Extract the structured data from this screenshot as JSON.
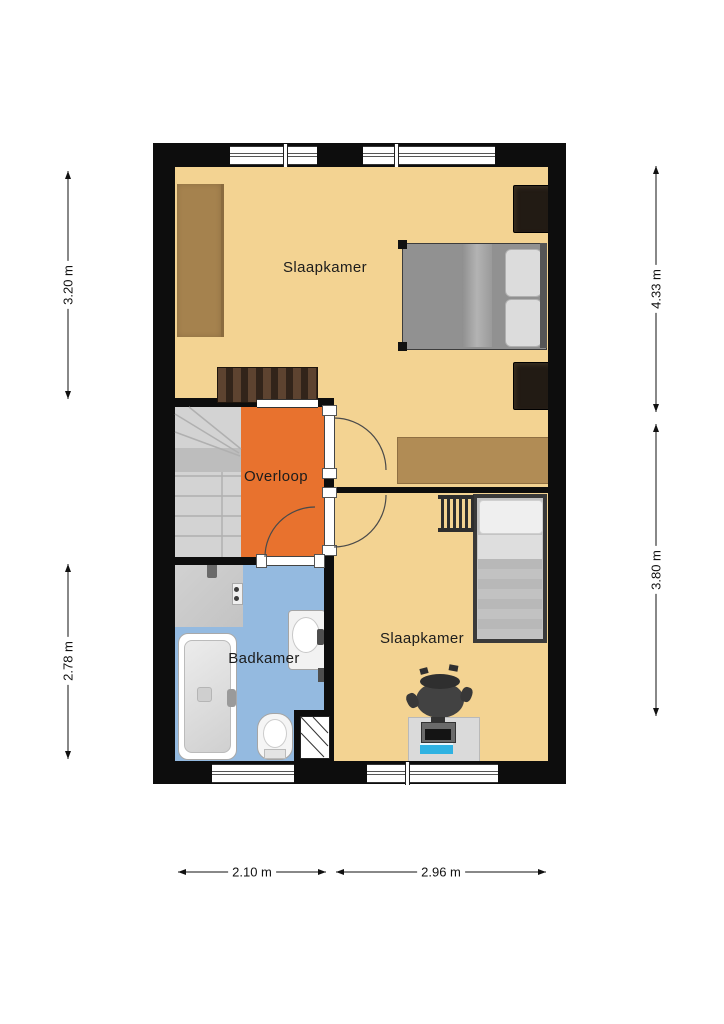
{
  "rooms": [
    {
      "id": "bedroom-1",
      "label": "Slaapkamer"
    },
    {
      "id": "landing",
      "label": "Overloop"
    },
    {
      "id": "bathroom",
      "label": "Badkamer"
    },
    {
      "id": "bedroom-2",
      "label": "Slaapkamer"
    }
  ],
  "dimensions": {
    "left_top": "3.20 m",
    "left_bottom": "2.78 m",
    "right_top": "4.33 m",
    "right_bottom": "3.80 m",
    "bottom_left": "2.10 m",
    "bottom_right": "2.96 m"
  },
  "colors": {
    "wall": "#0d0d0d",
    "bedroom_fill": "#F3D392",
    "landing_fill": "#E8722E",
    "bathroom_fill": "#94BAE0",
    "stairs_fill": "#D3D3D3",
    "wardrobe_wood": "#A5824E",
    "desk_wood": "#B18C55"
  },
  "furniture": [
    "wardrobe",
    "double-bed",
    "nightstand",
    "dresser",
    "desk",
    "single-bed",
    "bunk-ladder",
    "office-chair",
    "computer-desk",
    "shower",
    "bathtub",
    "toilet",
    "washbasin",
    "stairs",
    "duct-shaft"
  ]
}
